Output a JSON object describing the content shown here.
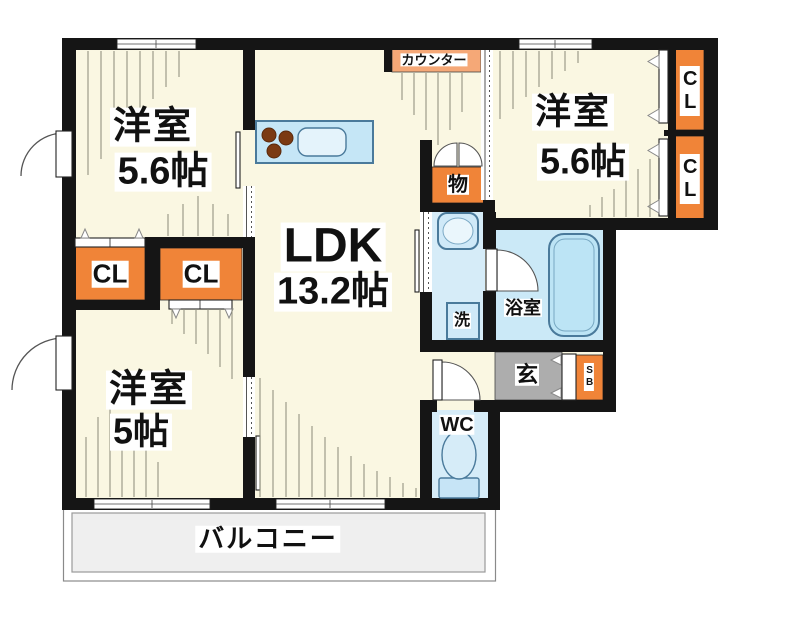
{
  "labels": {
    "room_tl_name": "洋室",
    "room_tl_size": "5.6帖",
    "room_tr_name": "洋室",
    "room_tr_size": "5.6帖",
    "room_bl_name": "洋室",
    "room_bl_size": "5帖",
    "ldk_name": "LDK",
    "ldk_size": "13.2帖",
    "balcony": "バルコニー",
    "counter": "カウンター",
    "storage": "物",
    "laundry": "洗",
    "bath": "浴室",
    "entrance": "玄",
    "shoe_box": "SB",
    "wc": "WC",
    "closet_left_1": "CL",
    "closet_left_2": "CL",
    "closet_right_1": "CL",
    "closet_right_2": "CL"
  },
  "icons": {
    "kitchen_counter": "kitchen-counter-icon",
    "burners": "stove-burners-icon",
    "sink": "kitchen-sink-icon",
    "bathtub": "bathtub-icon",
    "washbasin": "washbasin-icon",
    "toilet": "toilet-icon",
    "door_swing": "door-swing-arc-icon",
    "sliding_door": "sliding-door-icon",
    "folding_door": "folding-door-icon",
    "window": "window-icon"
  },
  "colors": {
    "wall": "#151515",
    "room": "#FAF7E2",
    "accent_orange": "#F08438",
    "counter_orange": "#F5A877",
    "water_blue": "#D6ECF8",
    "bath_blue": "#CBE9F7",
    "tub_blue": "#BCE4F5",
    "entry_gray": "#ADADAD",
    "balcony_gray": "#EFEFEF",
    "fixture_border": "#4A7A9B"
  }
}
